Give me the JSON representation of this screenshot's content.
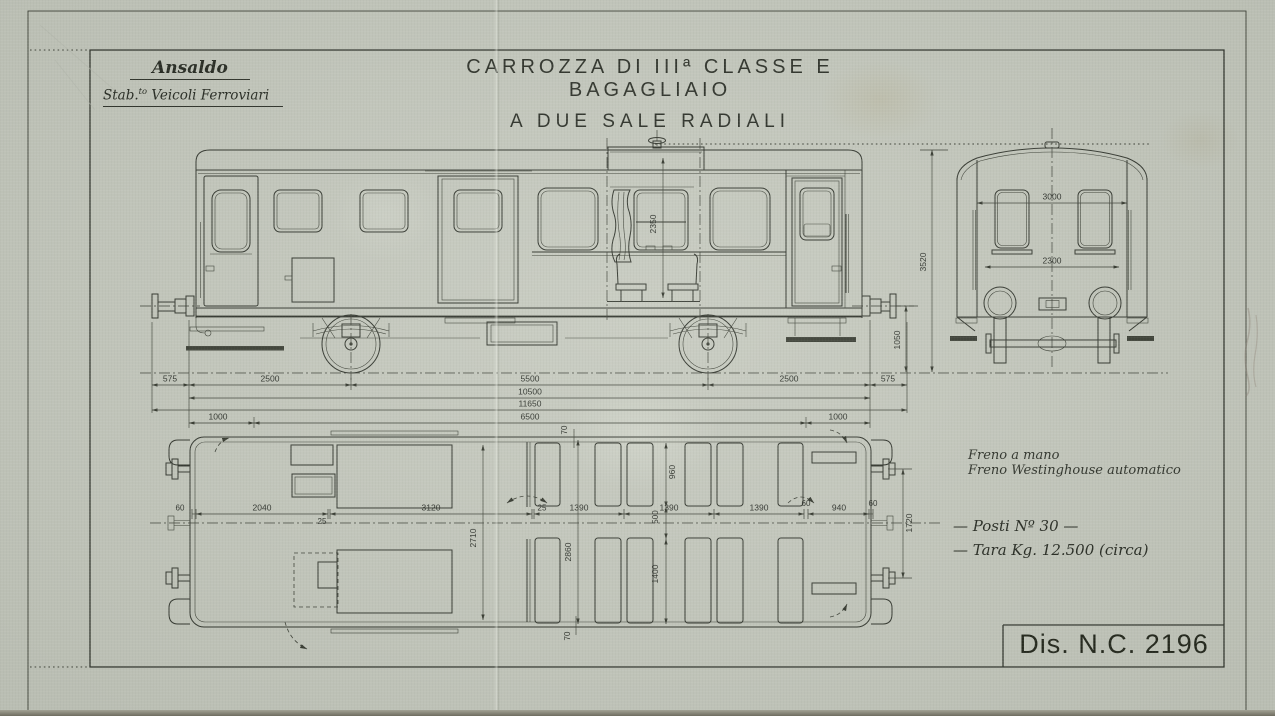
{
  "header": {
    "company": {
      "name": "Ansaldo",
      "dept_prefix": "Stab.",
      "dept_sup": "to",
      "dept_rest": " Veicoli Ferroviari"
    },
    "title1": "CARROZZA DI IIIª CLASSE E BAGAGLIAIO",
    "title2": "A DUE SALE RADIALI"
  },
  "dims": {
    "side_section_height": "2350",
    "side_total_height": "3520",
    "side_buffer_height": "1050",
    "row1": [
      "575",
      "2500",
      "5500",
      "2500",
      "575"
    ],
    "row2_total": "10500",
    "row3_overall": "11650",
    "row4": [
      "1000",
      "6500",
      "1000"
    ],
    "end_width_upper": "3000",
    "end_width_lower": "2300",
    "plan_row": [
      "60",
      "2040",
      "25",
      "3120",
      "25",
      "1390",
      "1390",
      "1390",
      "60",
      "940",
      "60"
    ],
    "plan_wall_top": "70",
    "plan_seat_top": "960",
    "plan_aisle": "500",
    "plan_seat_bottom": "1400",
    "plan_wall_bottom": "70",
    "plan_width_door": "2710",
    "plan_width_saloon": "2860",
    "plan_buffer_spacing": "1720"
  },
  "notes": {
    "line1": "Freno a mano",
    "line2": "Freno Westinghouse automatico",
    "seats": "—  Posti  Nº 30  —",
    "tara": "—  Tara  Kg. 12.500  (circa)"
  },
  "title_block": {
    "number": "Dis. N.C. 2196"
  },
  "colors": {
    "paper": "#c6cabf",
    "ink": "#30342c"
  }
}
